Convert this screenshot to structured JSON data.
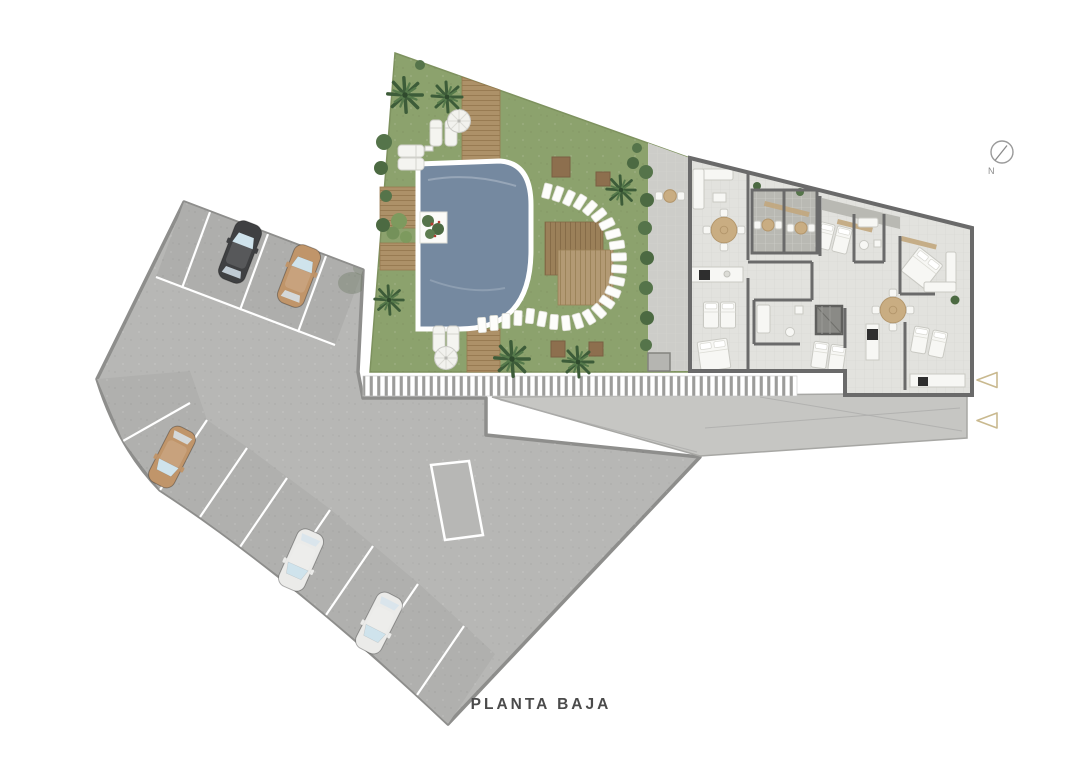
{
  "title": "PLANTA BAJA",
  "compass": {
    "label": "N"
  },
  "colors": {
    "background": "#ffffff",
    "parking": "#b7b7b5",
    "parking_band": "#aeaeac",
    "parking_border": "#8e8e8c",
    "sidewalk": "#c6c6c3",
    "grass": "#8ca26d",
    "pool": "#7589a0",
    "deck": "#ad9168",
    "deck_dark": "#9b8059",
    "deck_light": "#b39a74",
    "building_floor": "#e2e2de",
    "terrace_floor": "#b9b9b3",
    "patio": "#cdcdc9",
    "wall": "#6a6a6a",
    "wood_accent": "#c3a87e",
    "stall_line": "#ffffff",
    "fence_bar": "#9c9c9a",
    "car_black": "#3f4042",
    "car_tan": "#c0956a",
    "car_white": "#ebebe9",
    "palm_dark": "#3d5c39",
    "palm_mid": "#567a4b",
    "bush": "#55744a",
    "entrance_marker": "#c9b98f",
    "title_text": "#4b4b4b"
  },
  "parking": {
    "cars": [
      {
        "color": "black",
        "location": "top-row"
      },
      {
        "color": "tan",
        "location": "top-row"
      },
      {
        "color": "tan",
        "location": "side-row"
      },
      {
        "color": "white",
        "location": "side-row"
      },
      {
        "color": "white",
        "location": "side-row"
      }
    ],
    "stall_rows": 2,
    "top_row_stalls": 4,
    "side_row_stalls": 9
  },
  "amenities": {
    "pools": 1,
    "umbrellas": 2,
    "sun_loungers": 6,
    "palm_trees": 6,
    "stepping_stones": 25,
    "entrance_markers": 2
  }
}
